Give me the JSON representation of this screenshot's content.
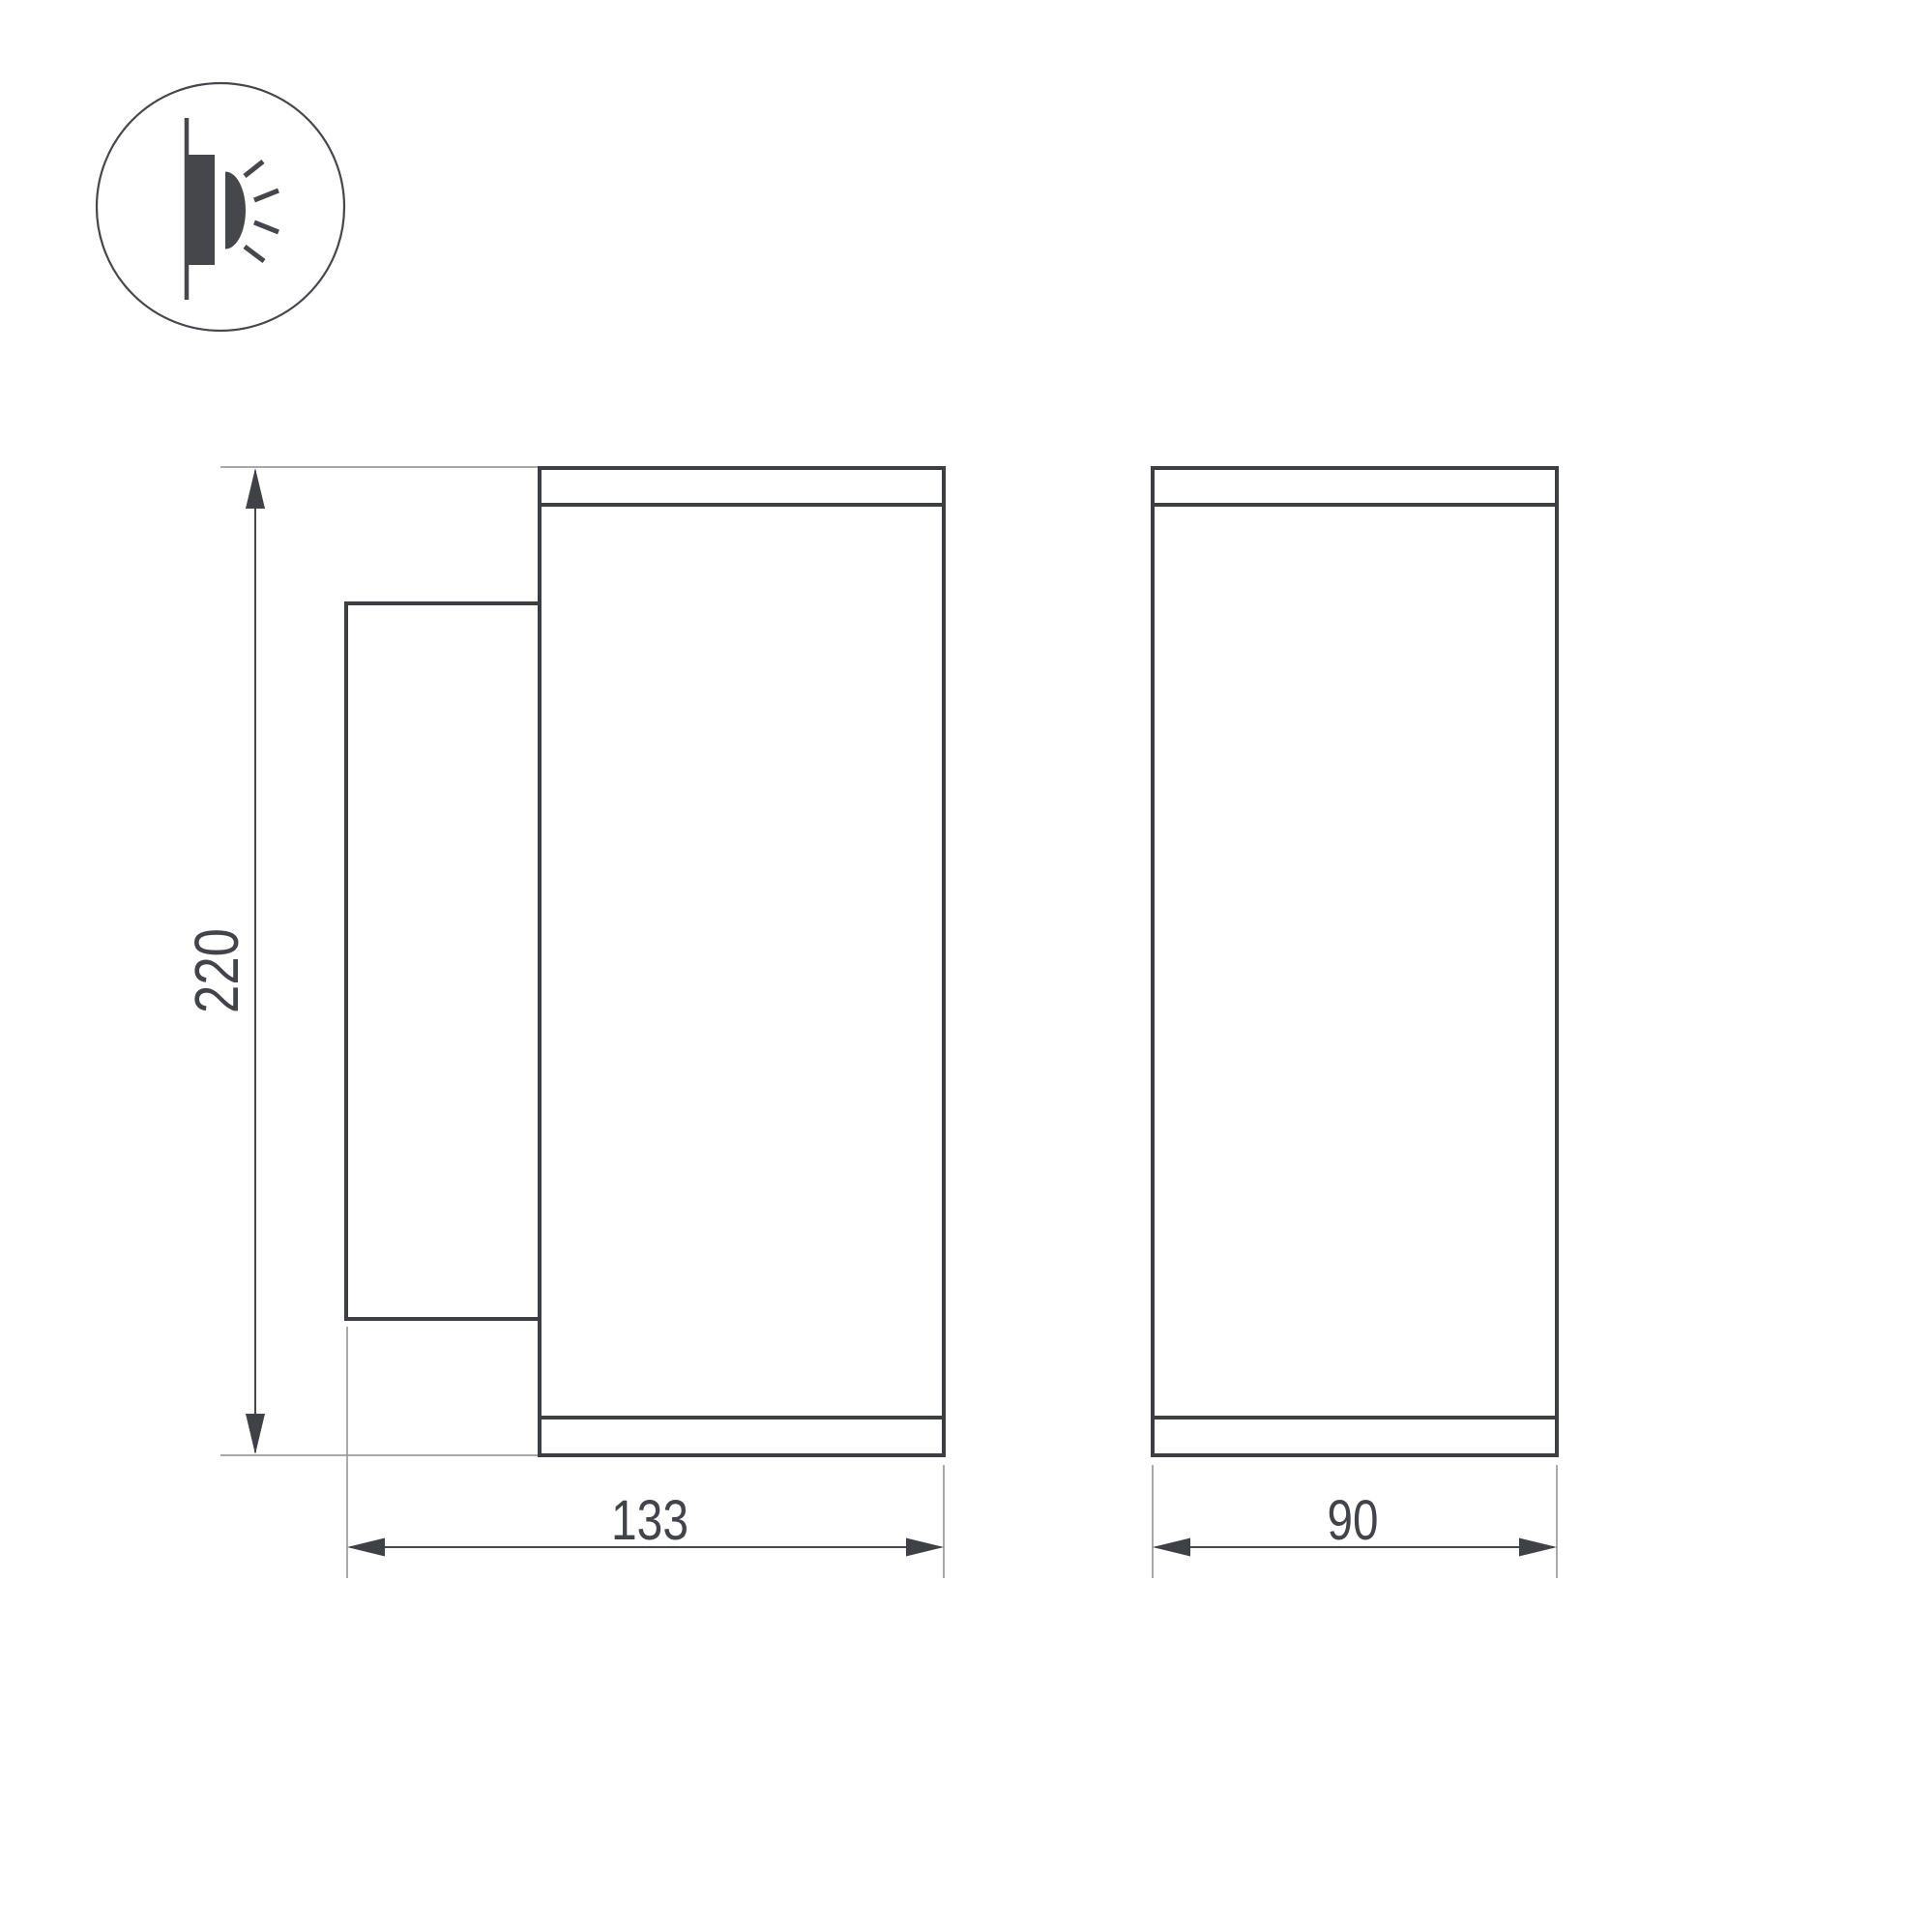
{
  "icon": {
    "name": "wall-light-icon",
    "description": "circled pictogram of a wall-mounted luminaire emitting light"
  },
  "colors": {
    "background": "#ffffff",
    "body_outline": "#3d3e42",
    "extension_line": "#9b9b9d",
    "dimension_line": "#47484c",
    "dimension_text": "#434449",
    "icon": "#46474b"
  },
  "views": {
    "side_view": {
      "name": "side-view"
    },
    "front_view": {
      "name": "front-view"
    }
  },
  "dimensions": {
    "height": {
      "value": "220"
    },
    "side_width": {
      "value": "133"
    },
    "front_width": {
      "value": "90"
    }
  }
}
